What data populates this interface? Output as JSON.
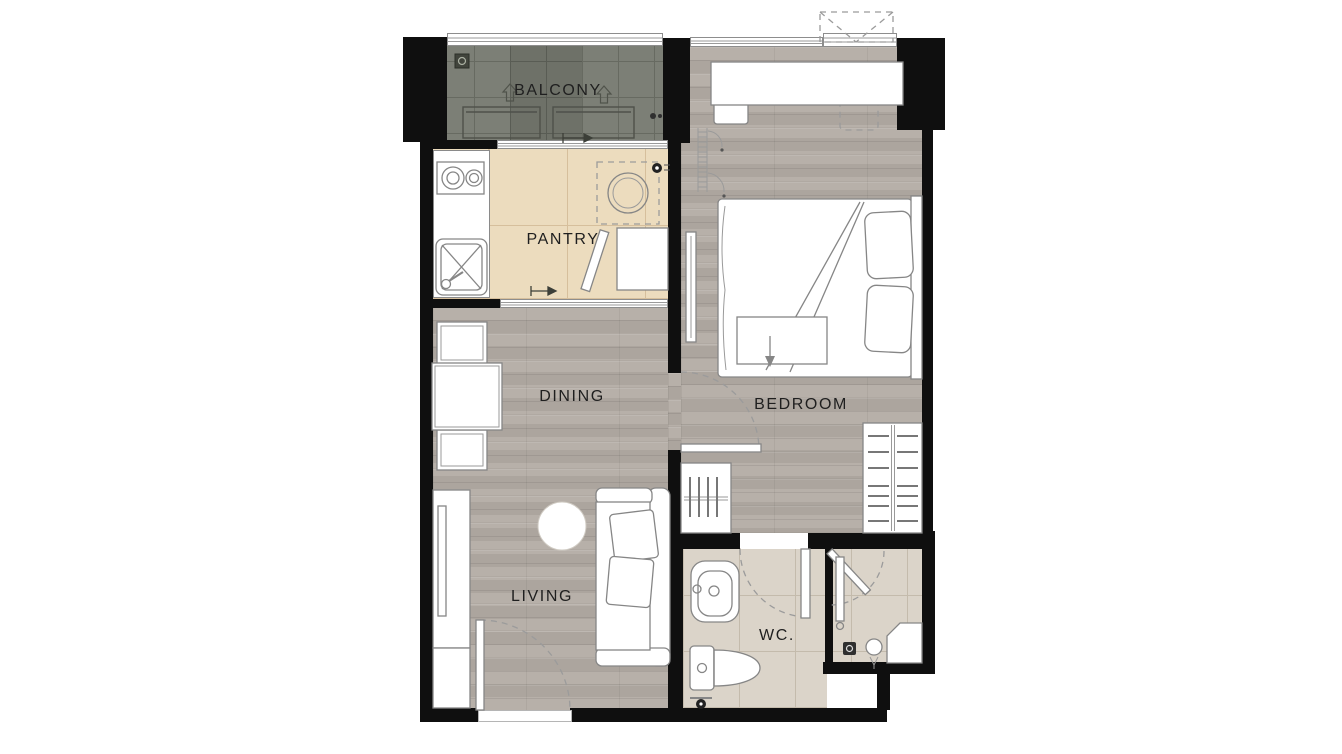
{
  "plan": {
    "type": "apartment-floor-plan"
  },
  "rooms": {
    "balcony": {
      "label": "BALCONY"
    },
    "pantry": {
      "label": "PANTRY"
    },
    "dining": {
      "label": "DINING"
    },
    "bedroom": {
      "label": "BEDROOM"
    },
    "living": {
      "label": "LIVING"
    },
    "wc": {
      "label": "WC."
    }
  },
  "colors": {
    "wall": "#0f0f0f",
    "text": "#1f1f1f",
    "bg": "#ffffff",
    "wood-floor": "#b7b0a9",
    "wood-floor-dark": "#aca59e",
    "pantry-floor": "#ecdcbe",
    "pantry-grout": "#d6bf9c",
    "balcony-floor": "#75786f",
    "balcony-grout": "#5f6259",
    "wc-floor": "#dbd4c9",
    "wc-grout": "#c4bbac",
    "fixture-line": "#8a8a8a"
  }
}
